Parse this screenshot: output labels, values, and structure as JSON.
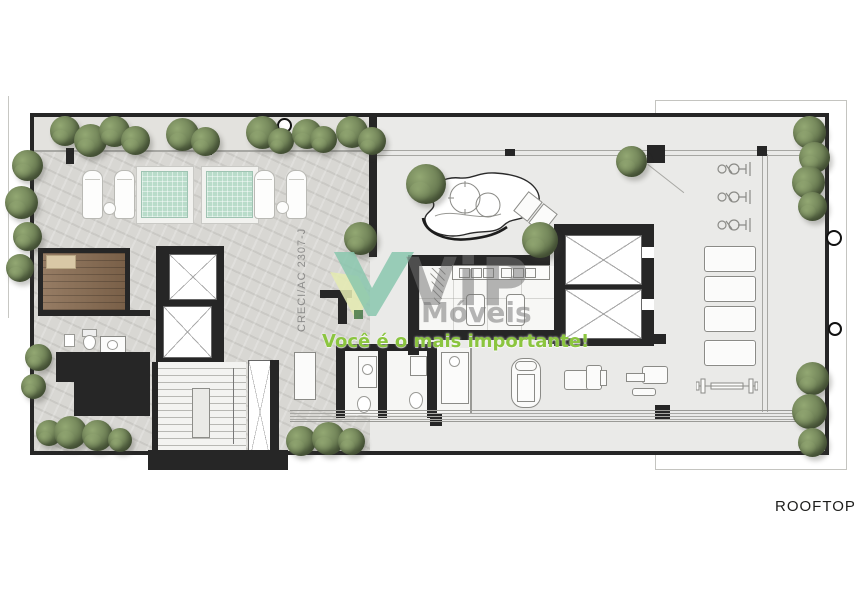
{
  "labels": {
    "floor_name": "ROOFTOP"
  },
  "watermark": {
    "registration": "CRECI/AC 2307-J",
    "brand": "ViP",
    "brand_sub": "Móveis",
    "slogan": "Você é o mais importante!"
  },
  "colors": {
    "wall": "#262626",
    "stone": "#d8d7d3",
    "hall": "#eaeae8",
    "pool": "#b9dcca",
    "wood": "#8a6d52",
    "sketch": "#8b8b87",
    "foliage_dark": "#5e6f49",
    "foliage_light": "#93a873",
    "slogan_green": "#8bc53f",
    "watermark_gray": "rgba(115,115,115,0.52)",
    "logo_teal": "rgba(134,198,172,0.82)",
    "logo_lime": "rgba(228,235,178,0.88)",
    "logo_pine": "rgba(70,120,72,0.85)",
    "label_ink": "#1d1d1b"
  }
}
